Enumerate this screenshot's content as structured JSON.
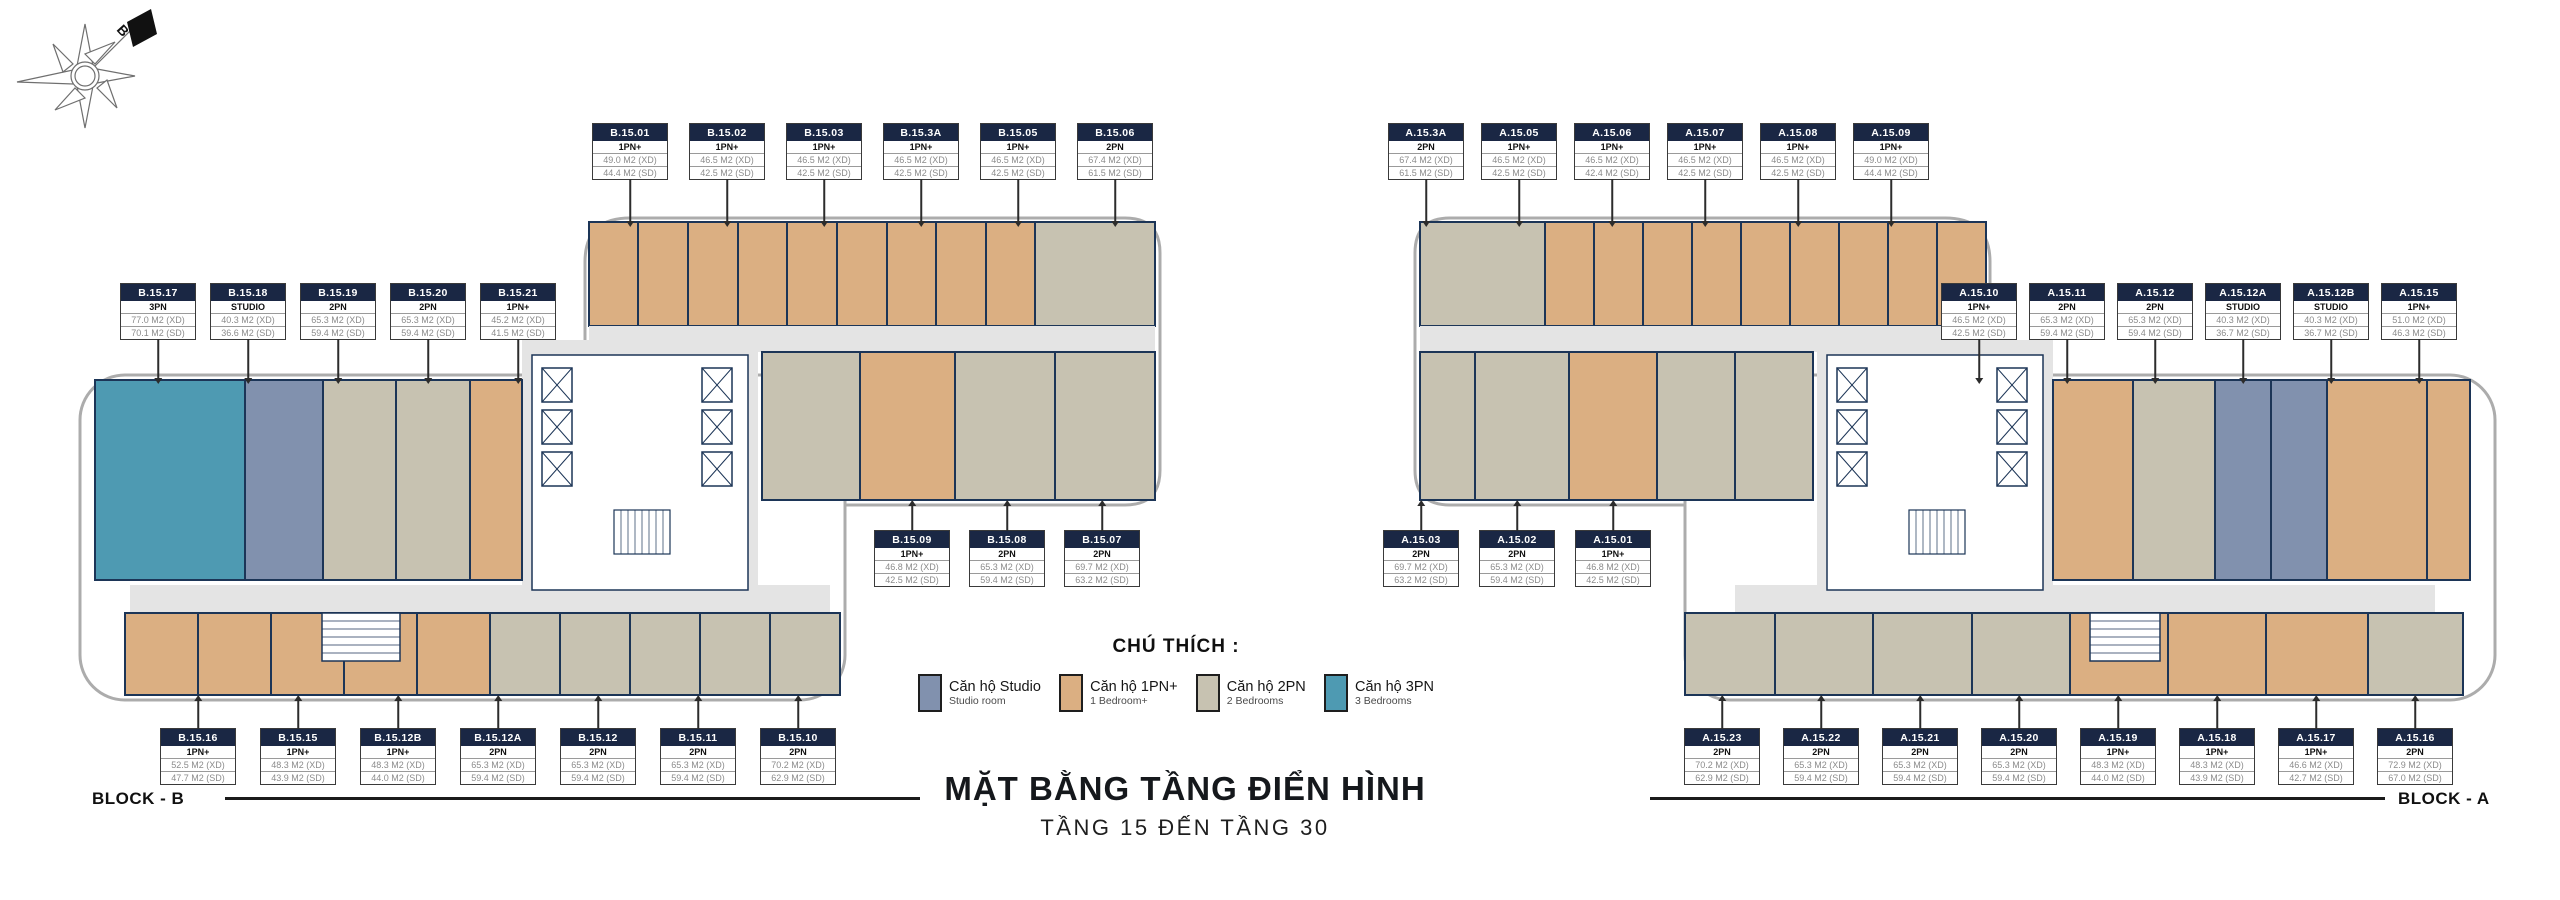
{
  "compass": {
    "north_label": "B"
  },
  "title": {
    "main": "MẶT BẰNG TẦNG ĐIỂN HÌNH",
    "sub": "TẦNG 15 ĐẾN TẦNG 30"
  },
  "legend": {
    "title": "CHÚ THÍCH :",
    "items": [
      {
        "name": "Căn hộ Studio",
        "sub": "Studio room",
        "color": "#8191AE"
      },
      {
        "name": "Căn hộ 1PN+",
        "sub": "1 Bedroom+",
        "color": "#DBAF82"
      },
      {
        "name": "Căn hộ 2PN",
        "sub": "2 Bedrooms",
        "color": "#C7C2B1"
      },
      {
        "name": "Căn hộ 3PN",
        "sub": "3 Bedrooms",
        "color": "#4E9AB2"
      }
    ]
  },
  "colors": {
    "wall": "#1C3557",
    "header": "#1A2744",
    "corridor": "#E4E4E4",
    "outline": "#ACACAC",
    "studio": "#8191AE",
    "tan": "#DBAF82",
    "gray2pn": "#C7C2B1",
    "teal": "#4E9AB2"
  },
  "blocks": {
    "b": {
      "label": "BLOCK - B",
      "groups": {
        "top": [
          {
            "id": "B.15.01",
            "type": "1PN+",
            "xd": "49.0 M2 (XD)",
            "sd": "44.4 M2 (SD)"
          },
          {
            "id": "B.15.02",
            "type": "1PN+",
            "xd": "46.5 M2 (XD)",
            "sd": "42.5 M2 (SD)"
          },
          {
            "id": "B.15.03",
            "type": "1PN+",
            "xd": "46.5 M2 (XD)",
            "sd": "42.5 M2 (SD)"
          },
          {
            "id": "B.15.3A",
            "type": "1PN+",
            "xd": "46.5 M2 (XD)",
            "sd": "42.5 M2 (SD)"
          },
          {
            "id": "B.15.05",
            "type": "1PN+",
            "xd": "46.5 M2 (XD)",
            "sd": "42.5 M2 (SD)"
          },
          {
            "id": "B.15.06",
            "type": "2PN",
            "xd": "67.4 M2 (XD)",
            "sd": "61.5 M2 (SD)"
          }
        ],
        "left": [
          {
            "id": "B.15.17",
            "type": "3PN",
            "xd": "77.0 M2 (XD)",
            "sd": "70.1 M2 (SD)"
          },
          {
            "id": "B.15.18",
            "type": "STUDIO",
            "xd": "40.3 M2 (XD)",
            "sd": "36.6 M2 (SD)"
          },
          {
            "id": "B.15.19",
            "type": "2PN",
            "xd": "65.3 M2 (XD)",
            "sd": "59.4 M2 (SD)"
          },
          {
            "id": "B.15.20",
            "type": "2PN",
            "xd": "65.3 M2 (XD)",
            "sd": "59.4 M2 (SD)"
          },
          {
            "id": "B.15.21",
            "type": "1PN+",
            "xd": "45.2 M2 (XD)",
            "sd": "41.5 M2 (SD)"
          }
        ],
        "mid": [
          {
            "id": "B.15.09",
            "type": "1PN+",
            "xd": "46.8 M2 (XD)",
            "sd": "42.5 M2 (SD)"
          },
          {
            "id": "B.15.08",
            "type": "2PN",
            "xd": "65.3 M2 (XD)",
            "sd": "59.4 M2 (SD)"
          },
          {
            "id": "B.15.07",
            "type": "2PN",
            "xd": "69.7 M2 (XD)",
            "sd": "63.2 M2 (SD)"
          }
        ],
        "bottom": [
          {
            "id": "B.15.16",
            "type": "1PN+",
            "xd": "52.5 M2 (XD)",
            "sd": "47.7 M2 (SD)"
          },
          {
            "id": "B.15.15",
            "type": "1PN+",
            "xd": "48.3 M2 (XD)",
            "sd": "43.9 M2 (SD)"
          },
          {
            "id": "B.15.12B",
            "type": "1PN+",
            "xd": "48.3 M2 (XD)",
            "sd": "44.0 M2 (SD)"
          },
          {
            "id": "B.15.12A",
            "type": "2PN",
            "xd": "65.3 M2 (XD)",
            "sd": "59.4 M2 (SD)"
          },
          {
            "id": "B.15.12",
            "type": "2PN",
            "xd": "65.3 M2 (XD)",
            "sd": "59.4 M2 (SD)"
          },
          {
            "id": "B.15.11",
            "type": "2PN",
            "xd": "65.3 M2 (XD)",
            "sd": "59.4 M2 (SD)"
          },
          {
            "id": "B.15.10",
            "type": "2PN",
            "xd": "70.2 M2 (XD)",
            "sd": "62.9 M2 (SD)"
          }
        ]
      }
    },
    "a": {
      "label": "BLOCK - A",
      "groups": {
        "top": [
          {
            "id": "A.15.3A",
            "type": "2PN",
            "xd": "67.4 M2 (XD)",
            "sd": "61.5 M2 (SD)"
          },
          {
            "id": "A.15.05",
            "type": "1PN+",
            "xd": "46.5 M2 (XD)",
            "sd": "42.5 M2 (SD)"
          },
          {
            "id": "A.15.06",
            "type": "1PN+",
            "xd": "46.5 M2 (XD)",
            "sd": "42.4 M2 (SD)"
          },
          {
            "id": "A.15.07",
            "type": "1PN+",
            "xd": "46.5 M2 (XD)",
            "sd": "42.5 M2 (SD)"
          },
          {
            "id": "A.15.08",
            "type": "1PN+",
            "xd": "46.5 M2 (XD)",
            "sd": "42.5 M2 (SD)"
          },
          {
            "id": "A.15.09",
            "type": "1PN+",
            "xd": "49.0 M2 (XD)",
            "sd": "44.4 M2 (SD)"
          }
        ],
        "right": [
          {
            "id": "A.15.10",
            "type": "1PN+",
            "xd": "46.5 M2 (XD)",
            "sd": "42.5 M2 (SD)"
          },
          {
            "id": "A.15.11",
            "type": "2PN",
            "xd": "65.3 M2 (XD)",
            "sd": "59.4 M2 (SD)"
          },
          {
            "id": "A.15.12",
            "type": "2PN",
            "xd": "65.3 M2 (XD)",
            "sd": "59.4 M2 (SD)"
          },
          {
            "id": "A.15.12A",
            "type": "STUDIO",
            "xd": "40.3 M2 (XD)",
            "sd": "36.7 M2 (SD)"
          },
          {
            "id": "A.15.12B",
            "type": "STUDIO",
            "xd": "40.3 M2 (XD)",
            "sd": "36.7 M2 (SD)"
          },
          {
            "id": "A.15.15",
            "type": "1PN+",
            "xd": "51.0 M2 (XD)",
            "sd": "46.3 M2 (SD)"
          }
        ],
        "mid": [
          {
            "id": "A.15.03",
            "type": "2PN",
            "xd": "69.7 M2 (XD)",
            "sd": "63.2 M2 (SD)"
          },
          {
            "id": "A.15.02",
            "type": "2PN",
            "xd": "65.3 M2 (XD)",
            "sd": "59.4 M2 (SD)"
          },
          {
            "id": "A.15.01",
            "type": "1PN+",
            "xd": "46.8 M2 (XD)",
            "sd": "42.5 M2 (SD)"
          }
        ],
        "bottom": [
          {
            "id": "A.15.23",
            "type": "2PN",
            "xd": "70.2 M2 (XD)",
            "sd": "62.9 M2 (SD)"
          },
          {
            "id": "A.15.22",
            "type": "2PN",
            "xd": "65.3 M2 (XD)",
            "sd": "59.4 M2 (SD)"
          },
          {
            "id": "A.15.21",
            "type": "2PN",
            "xd": "65.3 M2 (XD)",
            "sd": "59.4 M2 (SD)"
          },
          {
            "id": "A.15.20",
            "type": "2PN",
            "xd": "65.3 M2 (XD)",
            "sd": "59.4 M2 (SD)"
          },
          {
            "id": "A.15.19",
            "type": "1PN+",
            "xd": "48.3 M2 (XD)",
            "sd": "44.0 M2 (SD)"
          },
          {
            "id": "A.15.18",
            "type": "1PN+",
            "xd": "48.3 M2 (XD)",
            "sd": "43.9 M2 (SD)"
          },
          {
            "id": "A.15.17",
            "type": "1PN+",
            "xd": "46.6 M2 (XD)",
            "sd": "42.7 M2 (SD)"
          },
          {
            "id": "A.15.16",
            "type": "2PN",
            "xd": "72.9 M2 (XD)",
            "sd": "67.0 M2 (SD)"
          }
        ]
      }
    }
  }
}
